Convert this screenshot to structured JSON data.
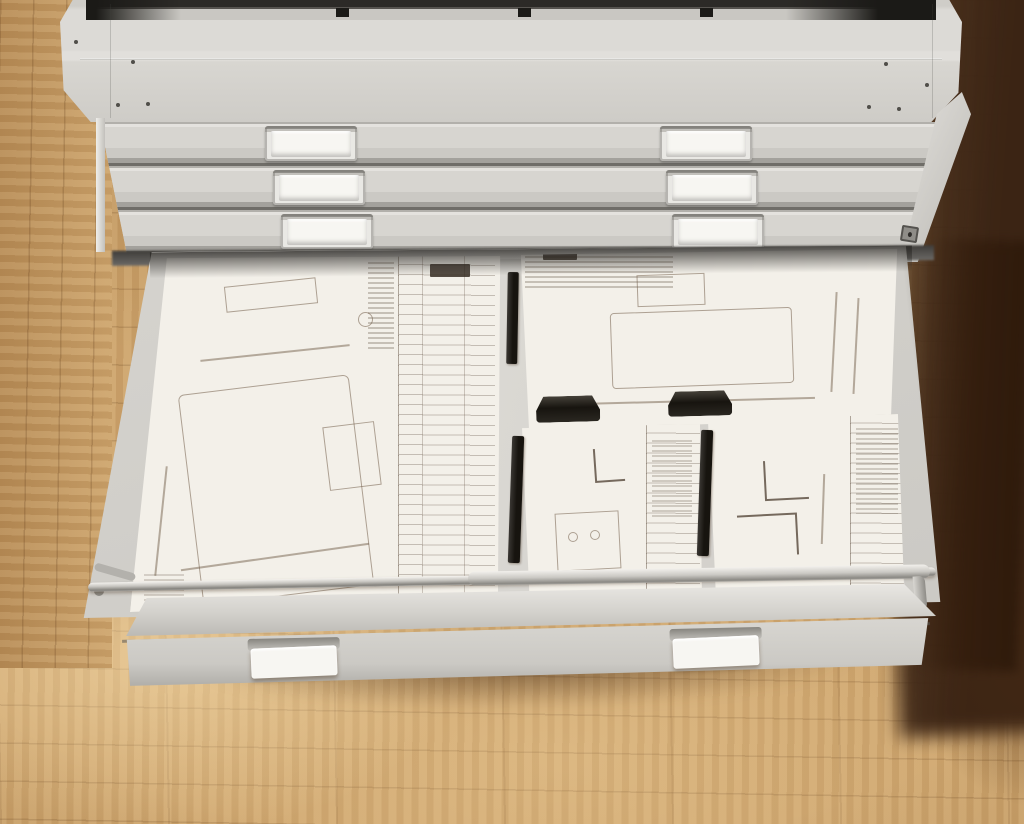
{
  "scene": {
    "type": "photograph",
    "subject": "Light grey steel flat-file plan cabinet standing on a wooden block floor, viewed from above-left; the bottom drawer is pulled open revealing technical drawings",
    "lighting": "bright from lower-left, deep shadow on the right side of the cabinet"
  },
  "colors": {
    "floor_light": "#cea56d",
    "floor_mid": "#b88d57",
    "floor_dark": "#3b2414",
    "floor_glow": "#ecd2a0",
    "cabinet": "#d5d3ce",
    "cabinet_bright": "#e6e4e0",
    "cabinet_shade": "#b9b7b2",
    "groove_dark": "#77756f",
    "label_card": "#f7f6f2",
    "drawer_interior": "#d9d7d2",
    "paper": "#f3f0e9",
    "ink": "#6e5f51",
    "clamp": "#17140f",
    "metal": "#c6c4bf",
    "opening_dark": "#2c2a27"
  },
  "cabinet": {
    "closed_drawer_count": 3,
    "top_vent_slot_count": 3,
    "drawers": [
      {
        "row": 1,
        "left_label": "",
        "right_label": ""
      },
      {
        "row": 2,
        "left_label": "",
        "right_label": ""
      },
      {
        "row": 3,
        "left_label": "",
        "right_label": ""
      }
    ],
    "side_lock_visible": true
  },
  "open_drawer": {
    "left_label": "",
    "right_label": "",
    "contents": {
      "sheets": [
        {
          "id": "large-blueprint",
          "position": "left",
          "features": "large outlined part drawing with dimension marks, title-block column of ruled rows along right edge"
        },
        {
          "id": "medium-blueprint",
          "position": "top-right",
          "features": "rectangular part with dimension lines, small data table top-left, held by two black wedge clamps"
        },
        {
          "id": "small-blueprint-1",
          "position": "bottom-center",
          "features": "small part sketches, ruled title block on right, black clamp strip on left edge"
        },
        {
          "id": "small-blueprint-2",
          "position": "bottom-right",
          "features": "stepped profile drawing, ruled title block on right, black clamp strip on left edge"
        }
      ],
      "hold_down_bar": "metal compressor bar hinged at left, spanning drawer width near front",
      "clamp_strip_count": 3,
      "wedge_clamp_count": 2
    }
  },
  "labels": {
    "blank": ""
  }
}
